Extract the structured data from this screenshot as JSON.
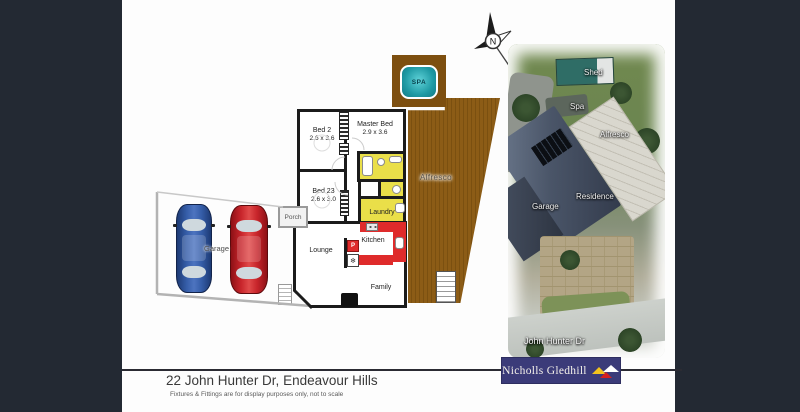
{
  "compass": {
    "label": "N"
  },
  "floorplan": {
    "spa": {
      "label": "SPA"
    },
    "alfresco": {
      "label": "Alfresco"
    },
    "rooms": {
      "bed2": {
        "label": "Bed 2",
        "dims": "2.6 x 3.6"
      },
      "master": {
        "label": "Master Bed",
        "dims": "2.9 x 3.6"
      },
      "bed23": {
        "label": "Bed 23",
        "dims": "2.6 x 3.0"
      },
      "laundry": {
        "label": "Laundry"
      },
      "kitchen": {
        "label": "Kitchen"
      },
      "lounge": {
        "label": "Lounge"
      },
      "family": {
        "label": "Family"
      },
      "porch": {
        "label": "Porch"
      },
      "garage": {
        "label": "Garage"
      }
    },
    "pantry_label": "P",
    "fridge_icon": "❄"
  },
  "aerial": {
    "labels": {
      "shed": "Shed",
      "spa": "Spa",
      "alfresco": "Alfresco",
      "residence": "Residence",
      "garage": "Garage",
      "street": "John Hunter Dr"
    }
  },
  "footer": {
    "address": "22 John Hunter Dr, Endeavour Hills",
    "disclaimer": "Fixtures & Fittings are for display purposes only, not to scale"
  },
  "brand": {
    "name": "Nicholls Gledhill"
  },
  "colors": {
    "frame_dark": "#232933",
    "deck_brown": "#8c5c16",
    "wet_area_yellow": "#eadf49",
    "kitchen_red": "#df2b2b",
    "spa_teal": "#1f9aa4",
    "logo_navy": "#3b3b79",
    "car_blue": "#355da8",
    "car_red": "#c8252b"
  }
}
